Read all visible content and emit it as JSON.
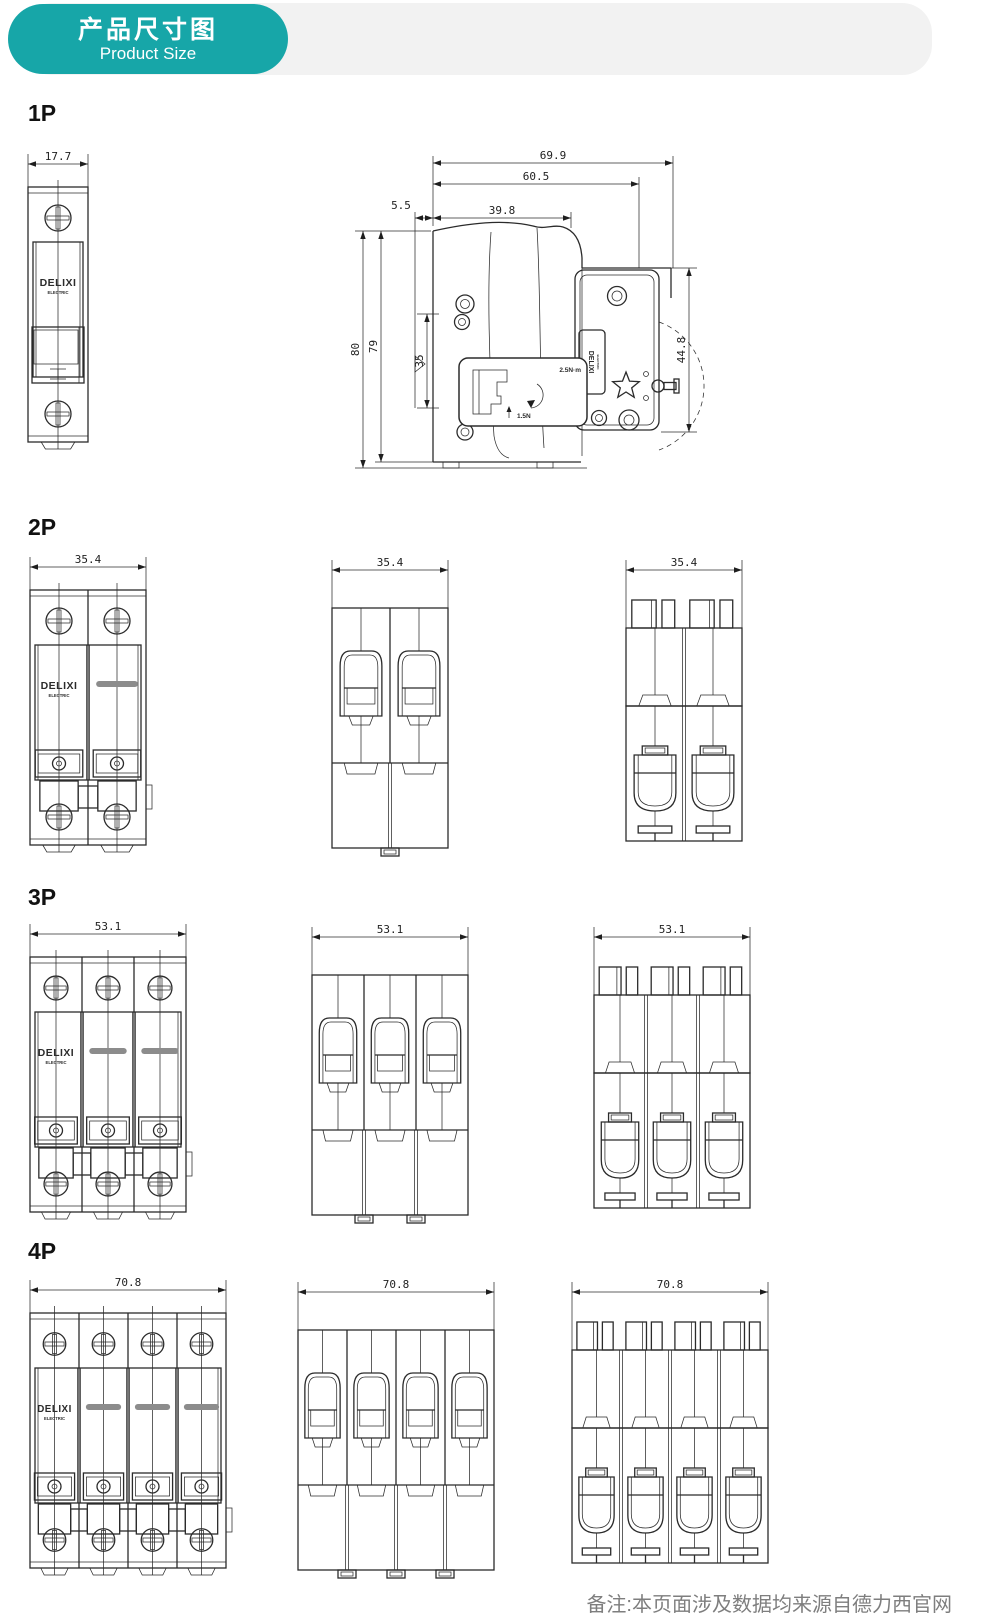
{
  "header": {
    "badge_title": "产品尺寸图",
    "badge_subtitle": "Product Size"
  },
  "brand": {
    "logo": "DELIXI",
    "logo_sub": "ELECTRIC"
  },
  "footer": {
    "note": "备注:本页面涉及数据均来源自德力西官网"
  },
  "colors": {
    "accent": "#17a6a8",
    "band": "#f2f2f2",
    "line": "#2b2b2b",
    "pole_bar": "#8c8c8c",
    "note_text": "#7e7e7e"
  },
  "sections": [
    {
      "label": "1P",
      "views": [
        {
          "name": "front",
          "width_mm": "17.7"
        },
        {
          "name": "side",
          "top_dims": [
            "69.9",
            "60.5",
            "39.8",
            "5.5"
          ],
          "height_dims": [
            "80",
            "79",
            "35"
          ],
          "plate_height_dim": "44.8",
          "inset_labels": [
            "2.5N·m",
            "1.5N"
          ]
        }
      ]
    },
    {
      "label": "2P",
      "views": [
        {
          "name": "front",
          "width_mm": "35.4"
        },
        {
          "name": "top",
          "width_mm": "35.4"
        },
        {
          "name": "rear",
          "width_mm": "35.4"
        }
      ]
    },
    {
      "label": "3P",
      "views": [
        {
          "name": "front",
          "width_mm": "53.1"
        },
        {
          "name": "top",
          "width_mm": "53.1"
        },
        {
          "name": "rear",
          "width_mm": "53.1"
        }
      ]
    },
    {
      "label": "4P",
      "views": [
        {
          "name": "front",
          "width_mm": "70.8"
        },
        {
          "name": "top",
          "width_mm": "70.8"
        },
        {
          "name": "rear",
          "width_mm": "70.8"
        }
      ]
    }
  ]
}
